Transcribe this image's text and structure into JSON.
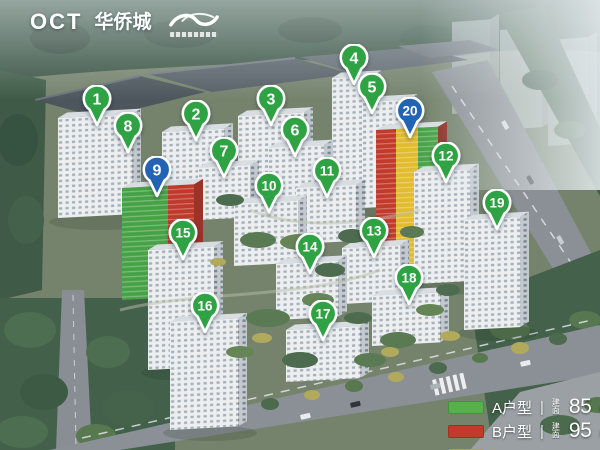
{
  "branding": {
    "oct_logo": "OCT",
    "oct_name": "华侨城",
    "partner_icon": "wave-ribbon-icon"
  },
  "legend": {
    "divider": "|",
    "rows": [
      {
        "type": "A户型",
        "area_label": "建面",
        "area": "85",
        "unit": "m²",
        "color": "#56b04c"
      },
      {
        "type": "B户型",
        "area_label": "建面",
        "area": "95",
        "unit": "m²",
        "color": "#c23a2c"
      },
      {
        "type": "",
        "area_label": "",
        "area": "",
        "unit": "",
        "color": "#e6c32f"
      }
    ]
  },
  "marker_colors": {
    "green": "#2fa344",
    "blue": "#2263b4"
  },
  "markers": [
    {
      "n": "1",
      "x": 97,
      "y": 100,
      "color": "green"
    },
    {
      "n": "2",
      "x": 196,
      "y": 115,
      "color": "green"
    },
    {
      "n": "3",
      "x": 271,
      "y": 100,
      "color": "green"
    },
    {
      "n": "4",
      "x": 354,
      "y": 59,
      "color": "green"
    },
    {
      "n": "5",
      "x": 372,
      "y": 88,
      "color": "green"
    },
    {
      "n": "6",
      "x": 295,
      "y": 131,
      "color": "green"
    },
    {
      "n": "7",
      "x": 224,
      "y": 152,
      "color": "green"
    },
    {
      "n": "8",
      "x": 128,
      "y": 127,
      "color": "green"
    },
    {
      "n": "9",
      "x": 157,
      "y": 171,
      "color": "blue"
    },
    {
      "n": "10",
      "x": 269,
      "y": 187,
      "color": "green"
    },
    {
      "n": "11",
      "x": 327,
      "y": 172,
      "color": "green"
    },
    {
      "n": "12",
      "x": 446,
      "y": 157,
      "color": "green"
    },
    {
      "n": "13",
      "x": 374,
      "y": 232,
      "color": "green"
    },
    {
      "n": "14",
      "x": 310,
      "y": 248,
      "color": "green"
    },
    {
      "n": "15",
      "x": 183,
      "y": 234,
      "color": "green"
    },
    {
      "n": "16",
      "x": 205,
      "y": 307,
      "color": "green"
    },
    {
      "n": "17",
      "x": 323,
      "y": 315,
      "color": "green"
    },
    {
      "n": "18",
      "x": 409,
      "y": 279,
      "color": "green"
    },
    {
      "n": "19",
      "x": 497,
      "y": 204,
      "color": "green"
    },
    {
      "n": "20",
      "x": 410,
      "y": 112,
      "color": "blue"
    }
  ]
}
